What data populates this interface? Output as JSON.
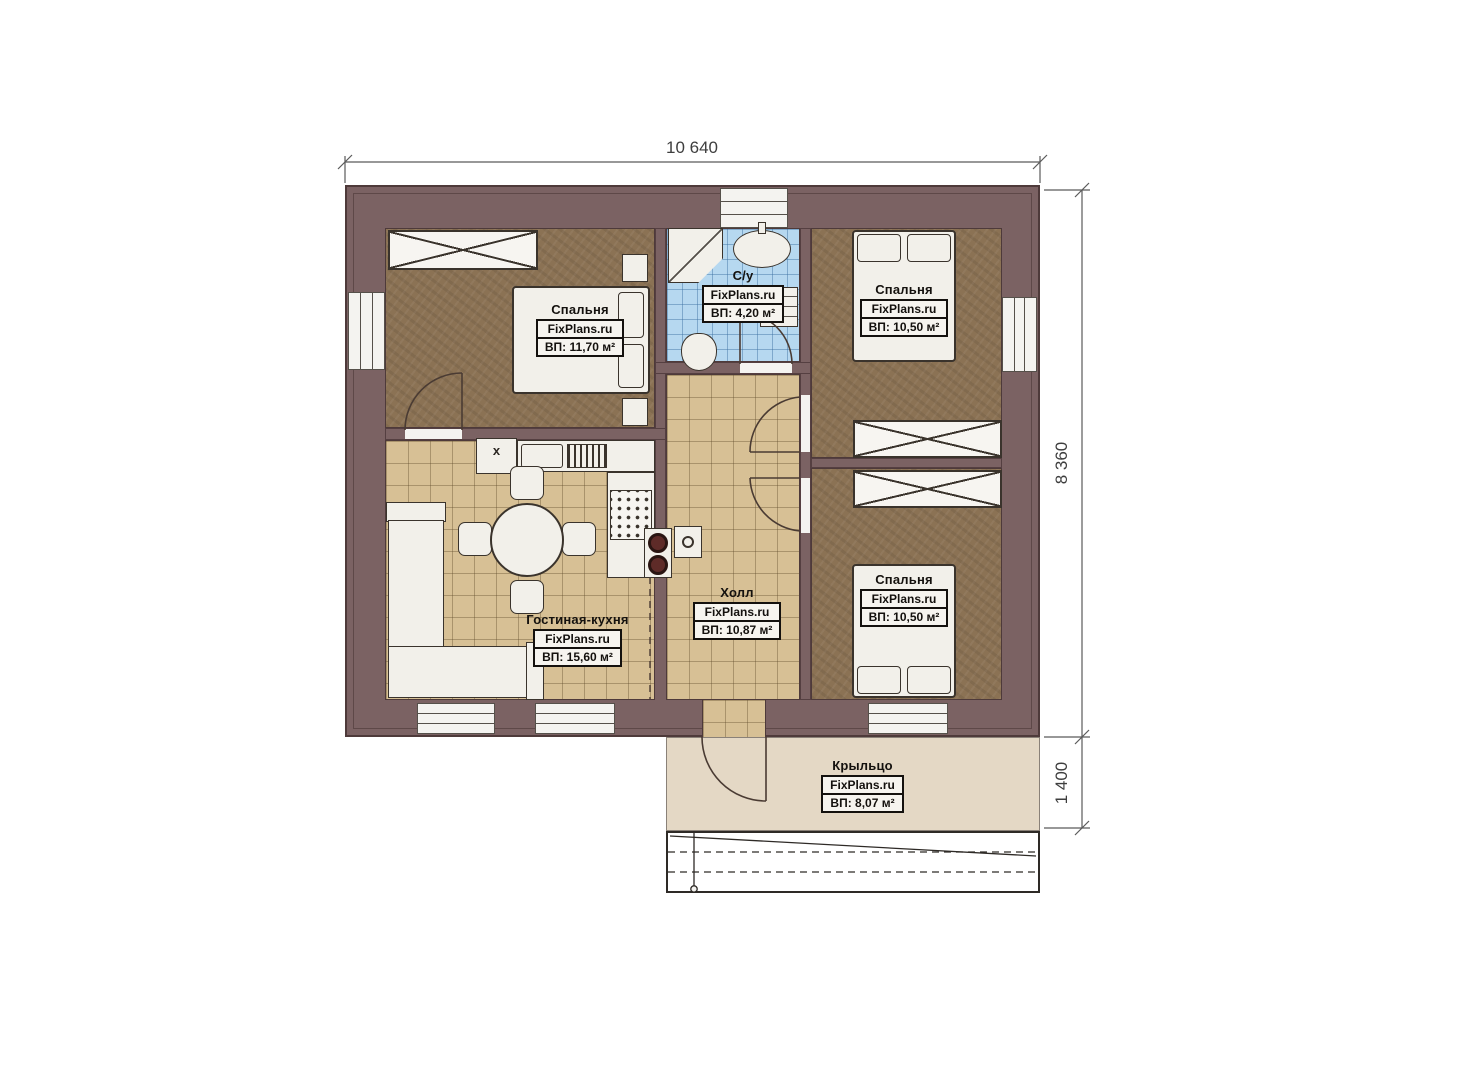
{
  "plan": {
    "dimensions": {
      "total_width_mm": "10 640",
      "total_height_mm": "8 360",
      "porch_depth_mm": "1 400"
    },
    "rooms": {
      "bedroom_top_left": {
        "name": "Спальня",
        "brand": "FixPlans.ru",
        "area": "ВП: 11,70 м²"
      },
      "bathroom": {
        "name": "С/у",
        "brand": "FixPlans.ru",
        "area": "ВП: 4,20 м²"
      },
      "bedroom_top_right": {
        "name": "Спальня",
        "brand": "FixPlans.ru",
        "area": "ВП: 10,50 м²"
      },
      "bedroom_bottom_right": {
        "name": "Спальня",
        "brand": "FixPlans.ru",
        "area": "ВП: 10,50 м²"
      },
      "hall": {
        "name": "Холл",
        "brand": "FixPlans.ru",
        "area": "ВП: 10,87 м²"
      },
      "living_kitchen": {
        "name": "Гостиная-кухня",
        "brand": "FixPlans.ru",
        "area": "ВП: 15,60 м²"
      },
      "porch": {
        "name": "Крыльцо",
        "brand": "FixPlans.ru",
        "area": "ВП: 8,07 м²"
      }
    },
    "annotations": {
      "washer_mark": "x"
    },
    "colors": {
      "wall": "#7b6263",
      "bedroom_floor": "#8b7254",
      "tile_floor": "#d7c095",
      "bath_floor": "#b6d8f0",
      "porch_floor": "#e4d8c5"
    }
  }
}
